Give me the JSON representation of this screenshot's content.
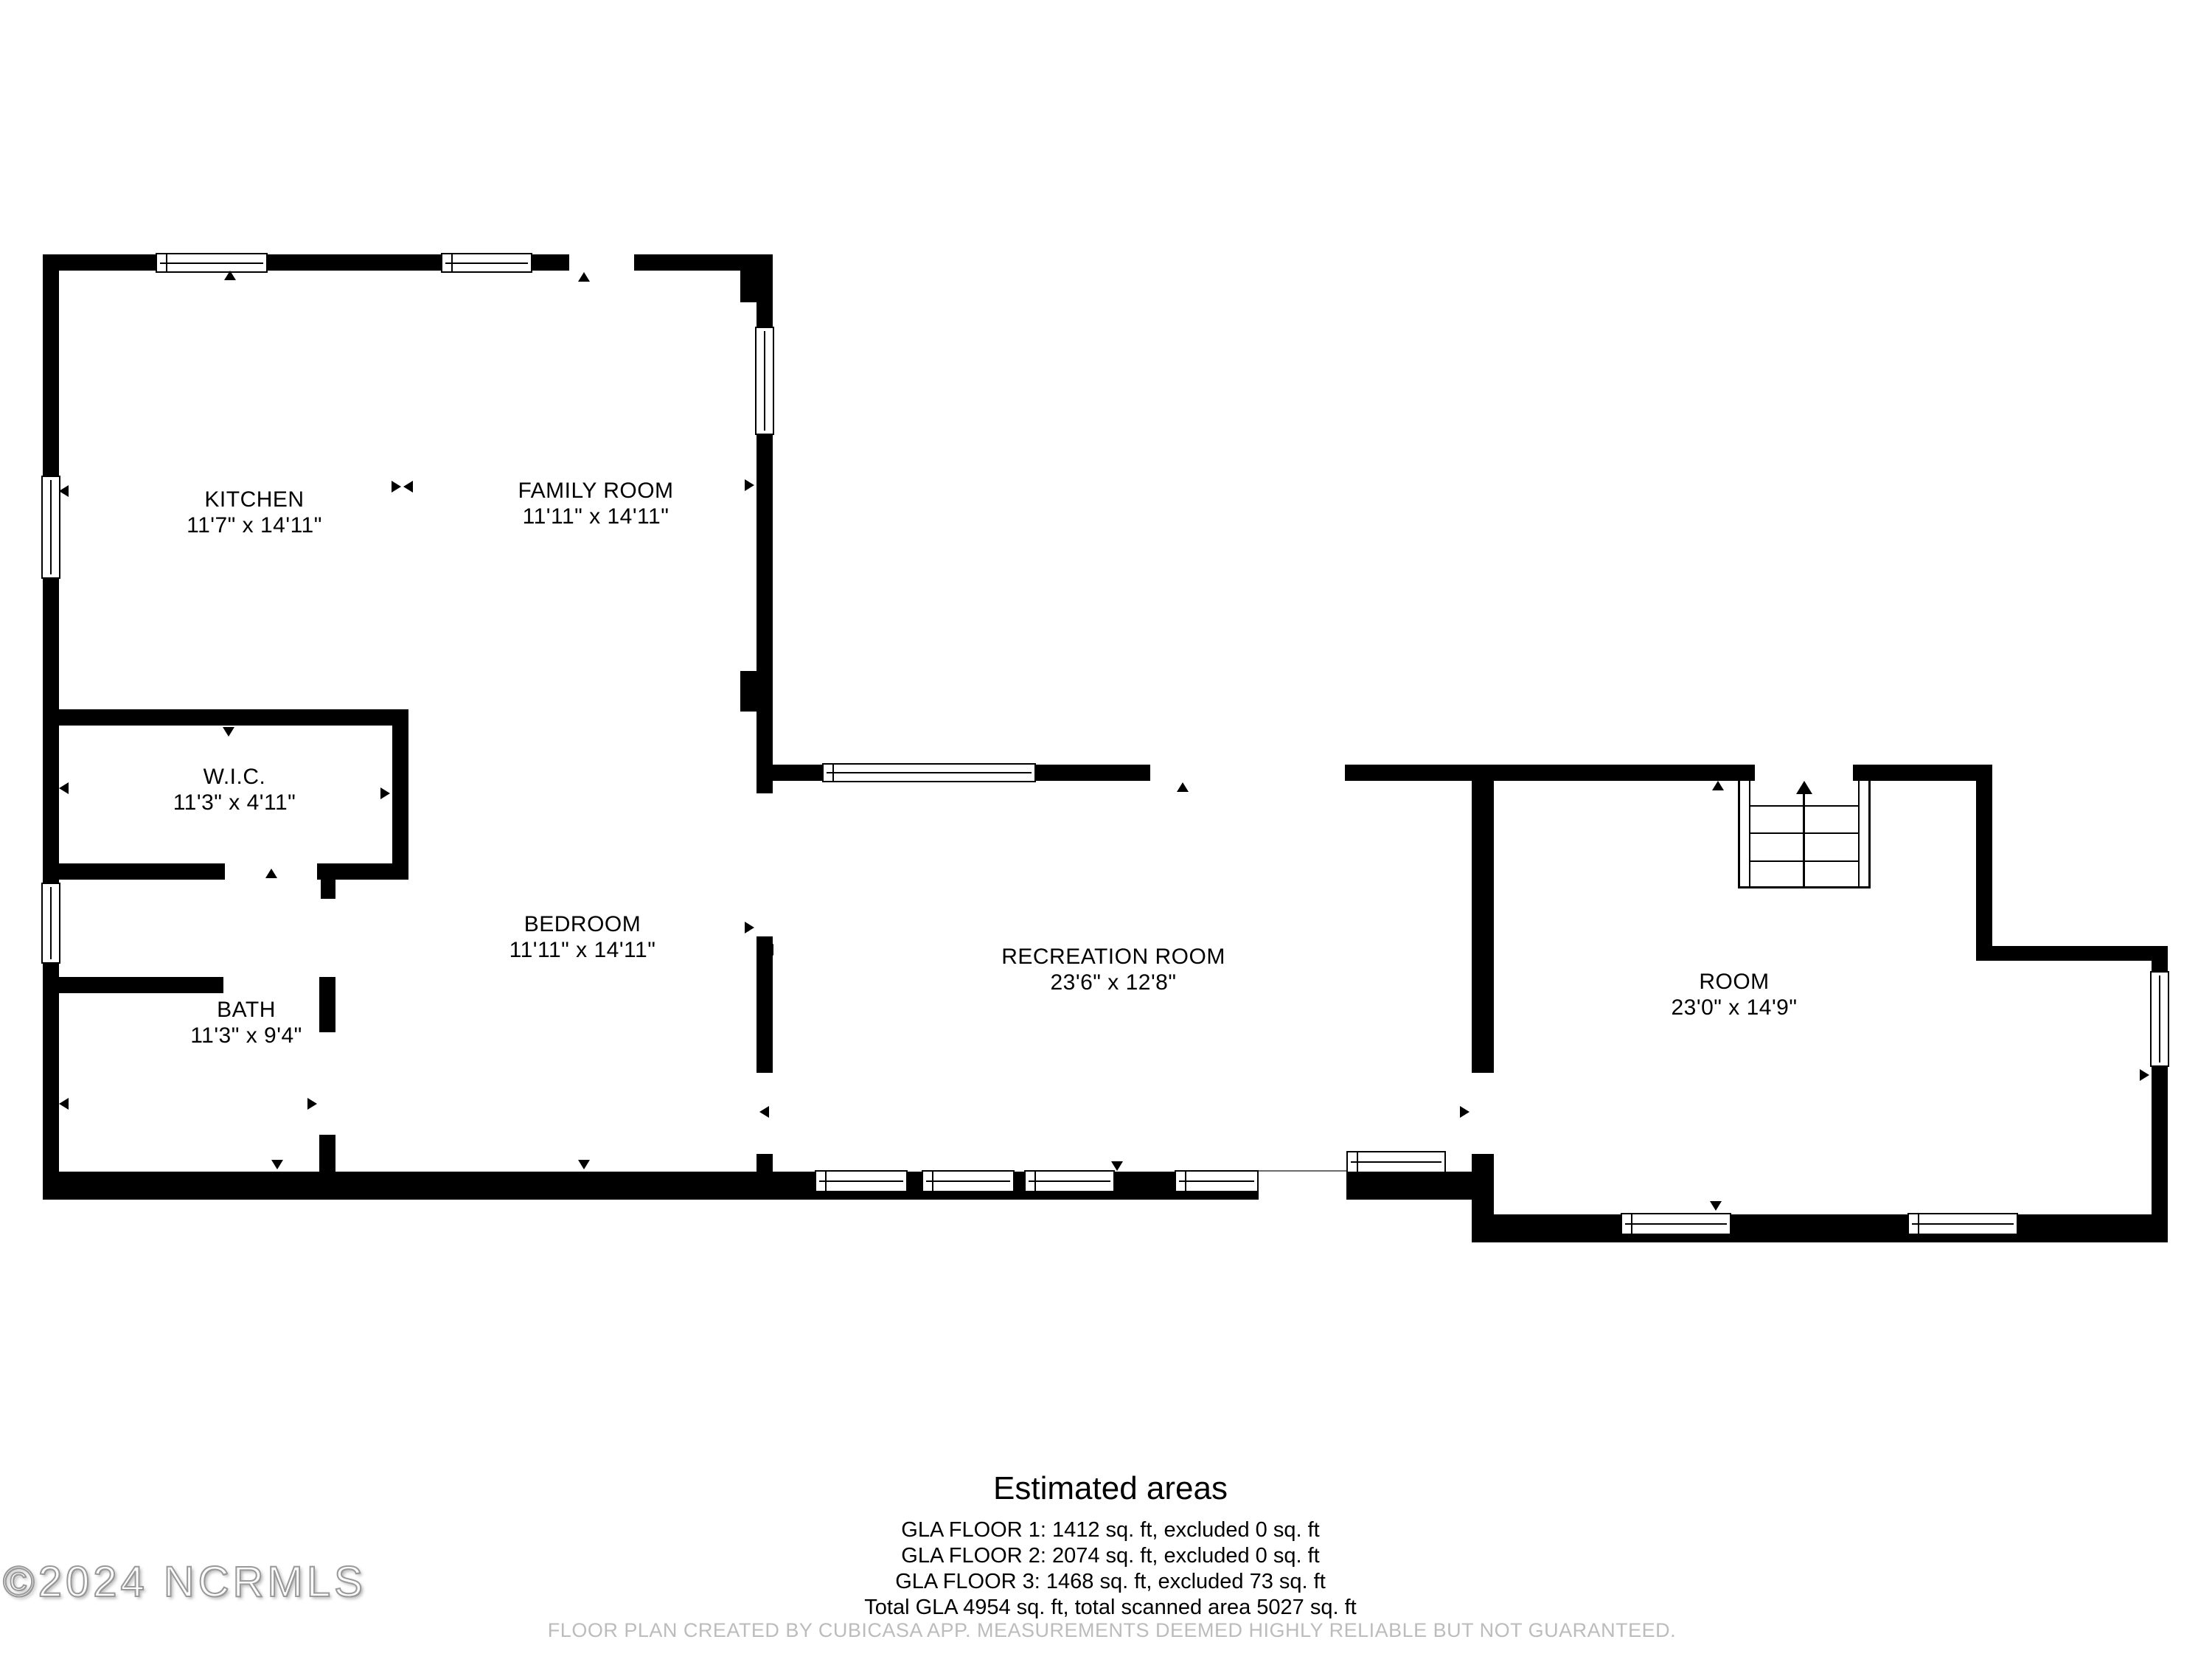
{
  "watermark": "©2024 NCRMLS",
  "rooms": {
    "kitchen": {
      "name": "KITCHEN",
      "dims": "11'7\" x 14'11\""
    },
    "family_room": {
      "name": "FAMILY ROOM",
      "dims": "11'11\" x 14'11\""
    },
    "wic": {
      "name": "W.I.C.",
      "dims": "11'3\" x 4'11\""
    },
    "bath": {
      "name": "BATH",
      "dims": "11'3\" x 9'4\""
    },
    "bedroom": {
      "name": "BEDROOM",
      "dims": "11'11\" x 14'11\""
    },
    "recreation_room": {
      "name": "RECREATION ROOM",
      "dims": "23'6\" x 12'8\""
    },
    "room": {
      "name": "ROOM",
      "dims": "23'0\" x 14'9\""
    }
  },
  "estimated_areas": {
    "title": "Estimated areas",
    "lines": [
      "GLA FLOOR 1: 1412 sq. ft, excluded 0 sq. ft",
      "GLA FLOOR 2: 2074 sq. ft, excluded 0 sq. ft",
      "GLA FLOOR 3: 1468 sq. ft, excluded 73 sq. ft",
      "Total GLA 4954 sq. ft, total scanned area 5027 sq. ft"
    ]
  },
  "footer": "FLOOR PLAN CREATED BY CUBICASA APP. MEASUREMENTS DEEMED HIGHLY RELIABLE BUT NOT GUARANTEED.",
  "colors": {
    "wall": "#000000",
    "background": "#ffffff",
    "footer_text": "#bcbcbc"
  }
}
